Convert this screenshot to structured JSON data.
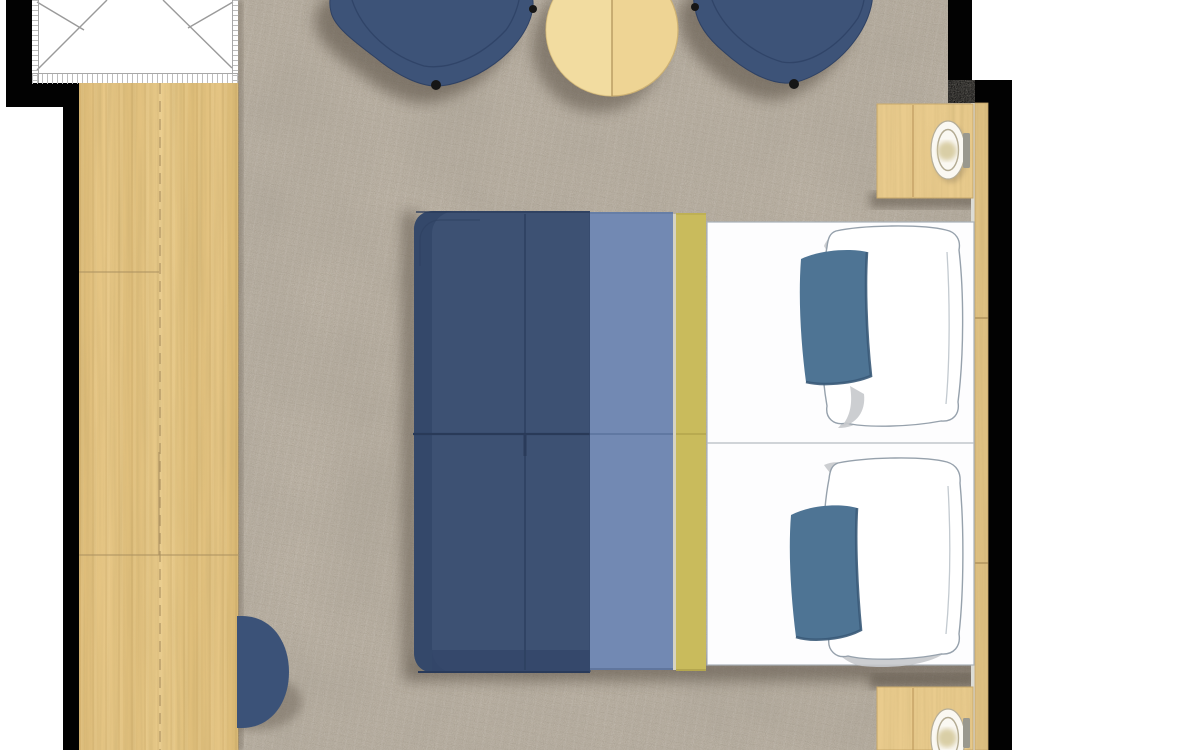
{
  "scene": {
    "kind": "floor-plan rendering",
    "subject": "hotel bedroom, top-down view",
    "items": [
      "closet",
      "wardrobe-panel",
      "carpet",
      "armchair-left",
      "armchair-right",
      "coffee-table",
      "nightstand-top",
      "table-lamp-top",
      "nightstand-bottom",
      "table-lamp-bottom",
      "double-bed",
      "duvet",
      "runner-light-blue",
      "runner-yellow",
      "pillow-white-top",
      "pillow-blue-top",
      "pillow-white-bottom",
      "pillow-blue-bottom",
      "headboard-panel",
      "ottoman-half-round",
      "walls"
    ]
  },
  "palette": {
    "exterior": "#ffffff",
    "wall": "#020202",
    "carpet": "#b4aa9b",
    "wood_seam": "#ab9160",
    "nightstand": "#e9cb8d",
    "table": "#eed494",
    "table_light": "#f5e0a6",
    "strip": "#dfc183",
    "ledge": "#dcdcd5",
    "chair": "#3d5378",
    "chair_seam": "#2f4366",
    "navy": "#3d5173",
    "navy_dark": "#334669",
    "navy_edge": "#2a3b5a",
    "blue_band": "#7289b3",
    "blue_band_line": "#5b729c",
    "yellow": "#c9bb5c",
    "yellow_line": "#b2a44d",
    "sheet": "#fdfdfe",
    "sheet_line": "#a9b1b8",
    "pillow_outline": "#96a1ac",
    "pillow_gray": "#c6c9cc",
    "pillow_blue": "#4e7494",
    "pillow_blue_dark": "#3a5a78",
    "pouf": "#3b5278",
    "lamp_ring": "#b3ab93",
    "lamp_glow": "#d8cca2",
    "handle": "#99988e",
    "shadow": "#554c3f",
    "foot": "#161616"
  }
}
